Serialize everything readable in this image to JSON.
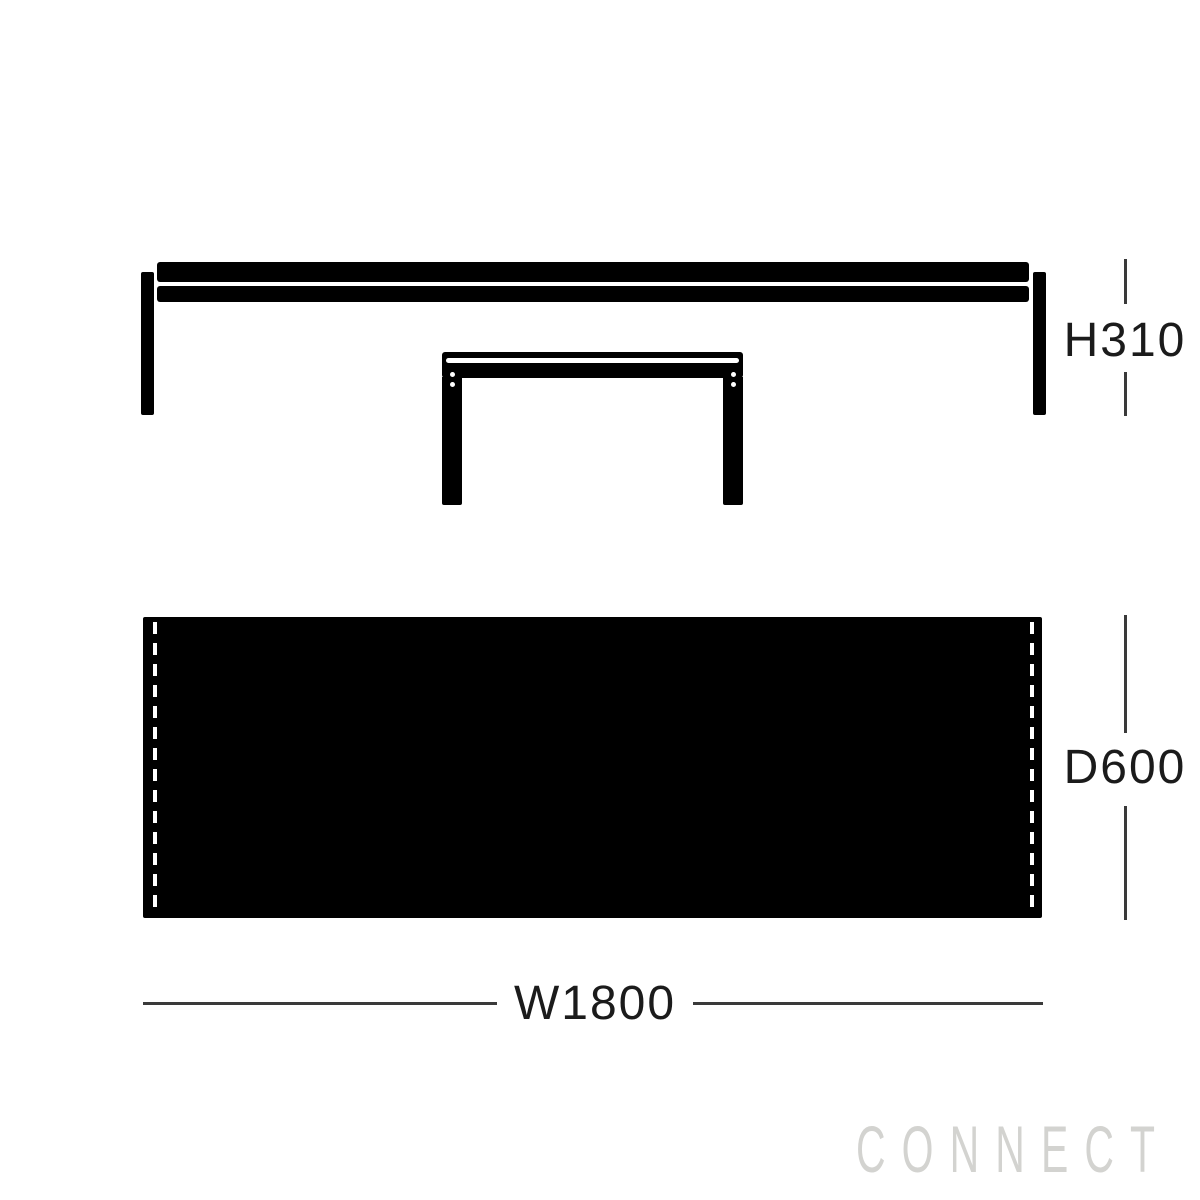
{
  "diagram": {
    "labels": {
      "height": "H310",
      "depth": "D600",
      "width": "W1800"
    },
    "watermark": "CONNECT",
    "colors": {
      "figure": "#000000",
      "dimension_lines": "#3a3a3a",
      "label_text": "#1b1b1b",
      "watermark_text": "#d3d3d0",
      "background": "#ffffff"
    }
  }
}
